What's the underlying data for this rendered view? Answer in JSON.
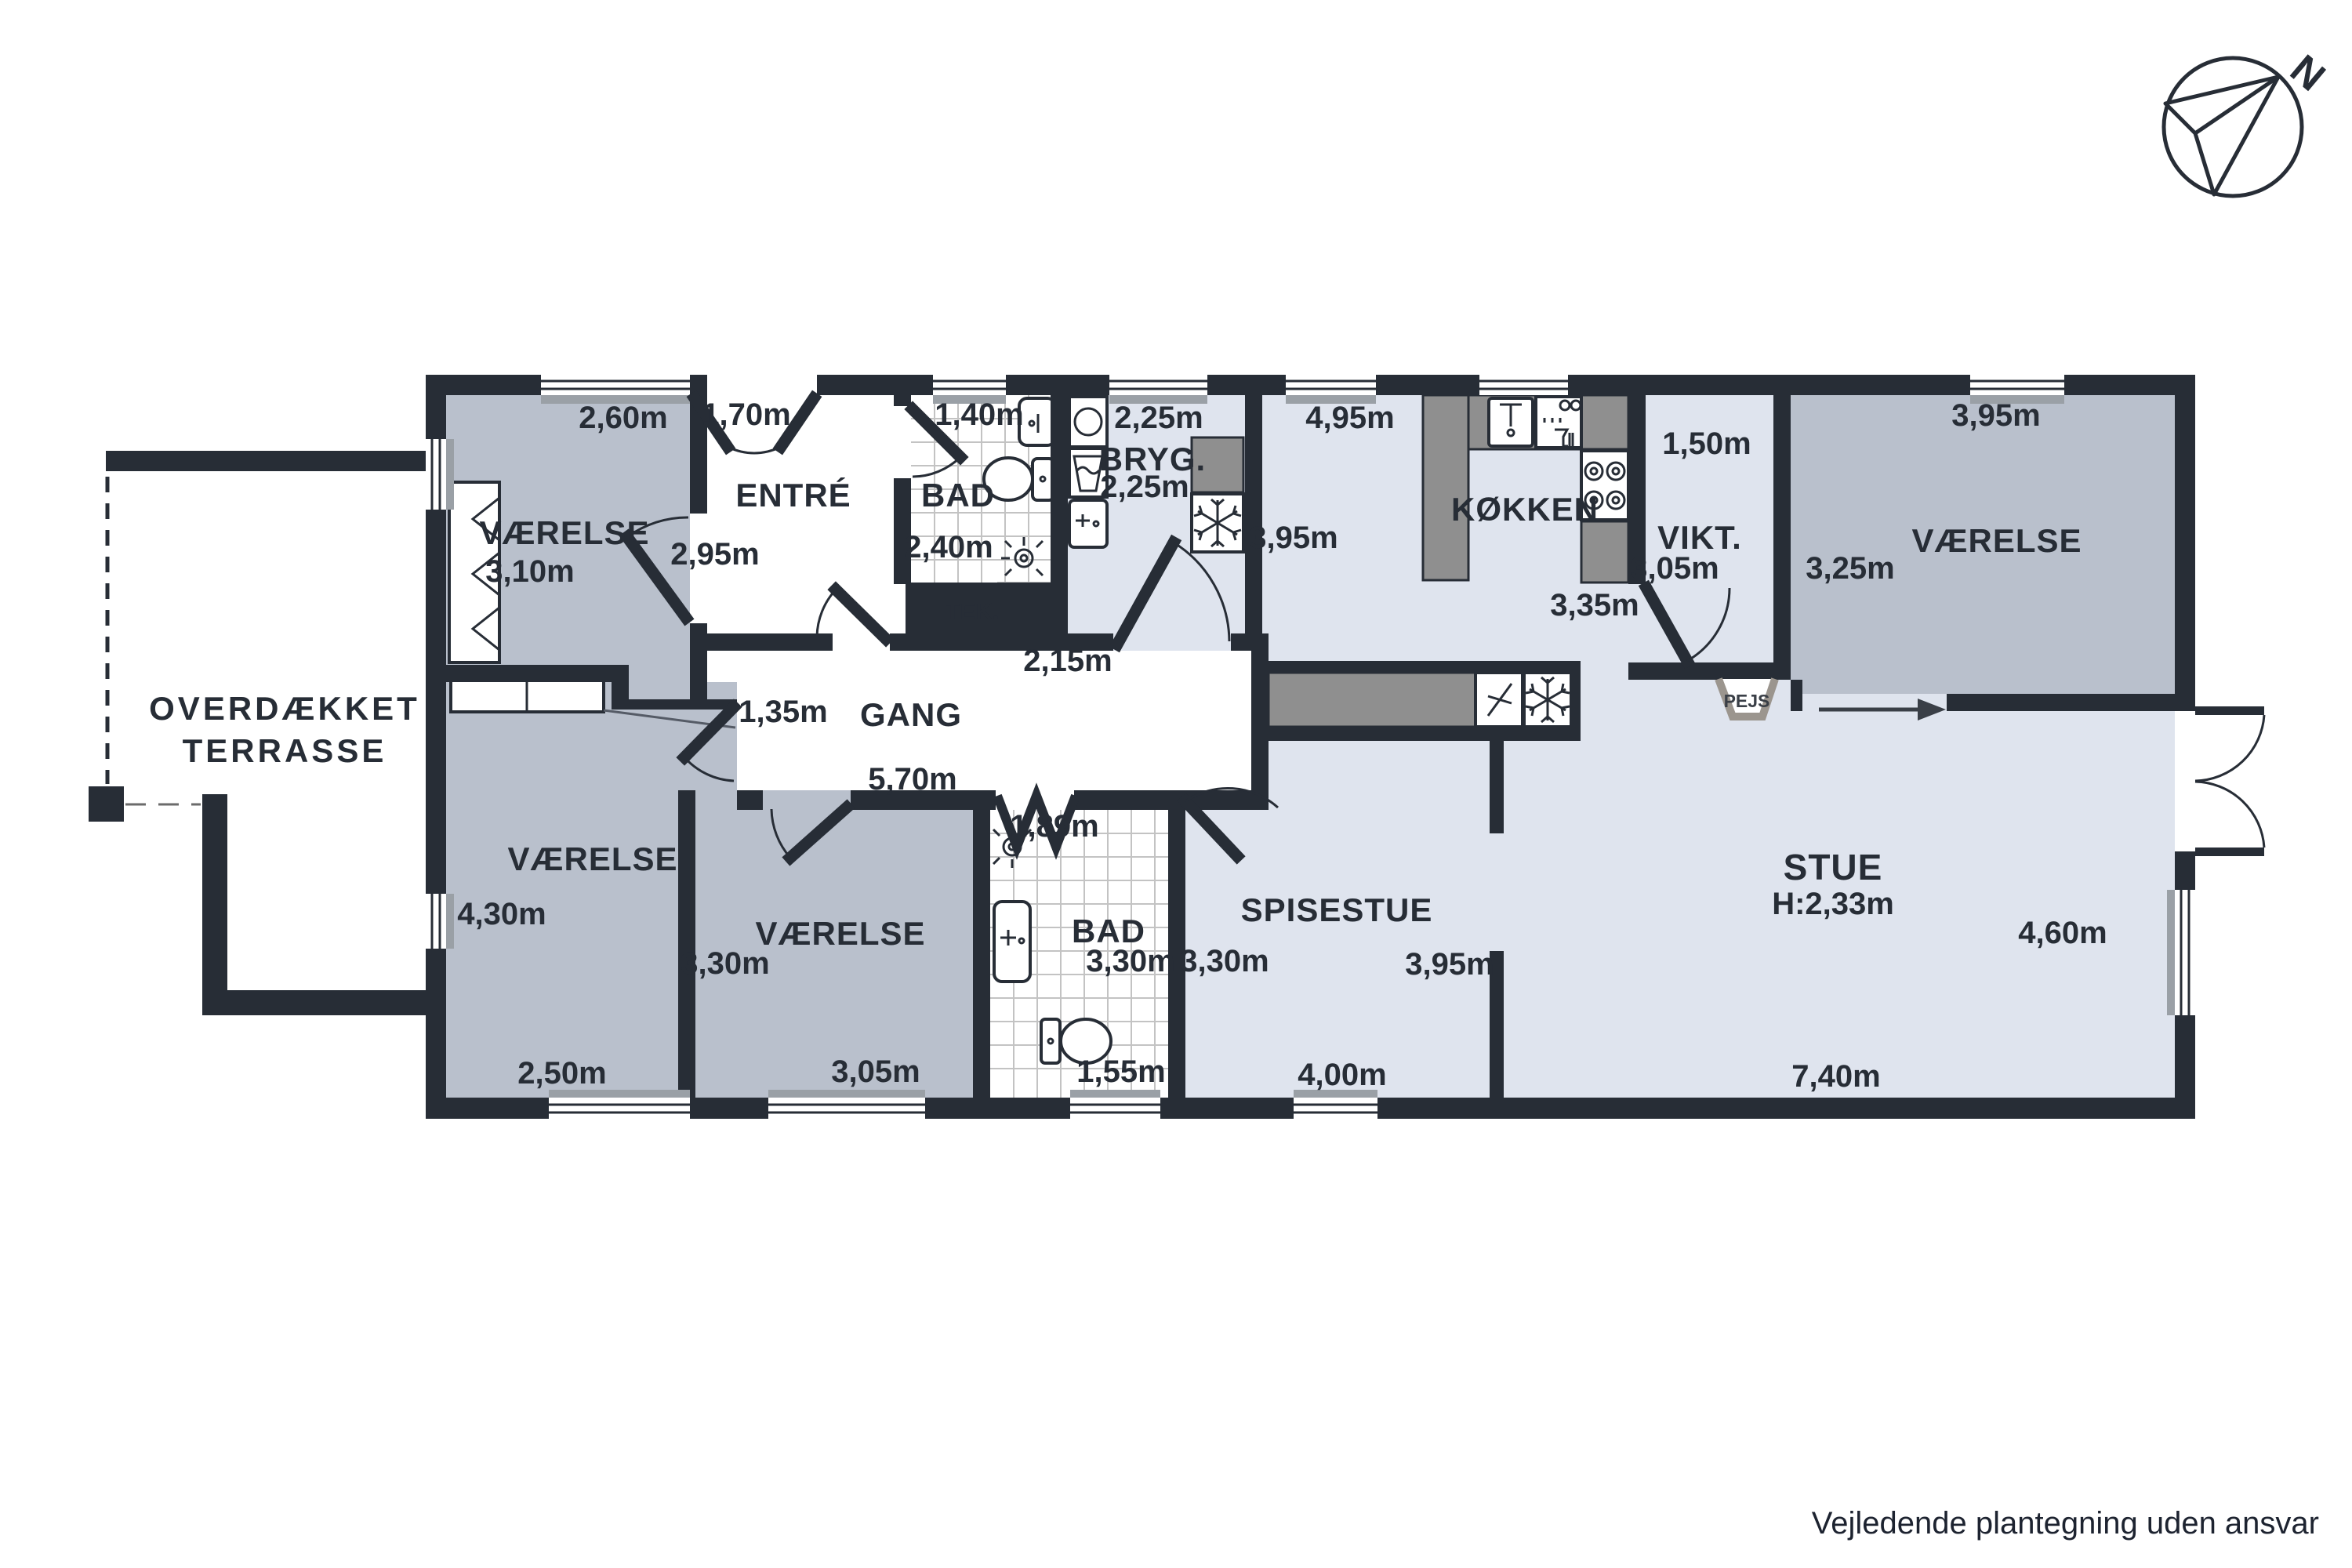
{
  "plan": {
    "disclaimer": "Vejledende plantegning uden ansvar",
    "compass_label": "N",
    "terrace": {
      "line1": "OVERDÆKKET",
      "line2": "TERRASSE"
    },
    "pejs_label": "PEJS",
    "rooms": {
      "vaerelse_nw": {
        "name": "VÆRELSE",
        "w": "2,60m",
        "h": "3,10m"
      },
      "entre": {
        "name": "ENTRÉ",
        "w": "1,70m",
        "h": "2,95m"
      },
      "bad_top": {
        "name": "BAD",
        "w": "1,40m",
        "h": "2,40m"
      },
      "tek": {
        "name": "TEK."
      },
      "bryg": {
        "name": "BRYG.",
        "w": "2,25m",
        "h": "2,25m"
      },
      "dining": {
        "w": "4,95m",
        "h": "3,95m"
      },
      "koekken": {
        "name": "KØKKEN",
        "w": "3,35m"
      },
      "vikt": {
        "name": "VIKT.",
        "w": "1,50m",
        "h": "3,05m"
      },
      "vaerelse_ne": {
        "name": "VÆRELSE",
        "w": "3,95m",
        "h": "3,25m"
      },
      "gang": {
        "name": "GANG",
        "left": "1,35m",
        "bottom": "5,70m",
        "right": "2,15m"
      },
      "vaerelse_sw": {
        "name": "VÆRELSE",
        "h": "4,30m",
        "w": "2,50m"
      },
      "vaerelse_s": {
        "name": "VÆRELSE",
        "h": "3,30m",
        "w": "3,05m"
      },
      "bad_bottom": {
        "name": "BAD",
        "top": "1,89m",
        "h": "3,30m",
        "w": "1,55m"
      },
      "spisestue": {
        "name": "SPISESTUE",
        "left": "3,30m",
        "right": "3,95m",
        "bottom": "4,00m"
      },
      "stue": {
        "name": "STUE",
        "ceiling": "H:2,33m",
        "right": "4,60m",
        "bottom": "7,40m"
      }
    },
    "colors": {
      "wall": "#272d36",
      "room_gray": "#b9c0cc",
      "room_blue": "#dfe4ee",
      "counter_gray": "#8f8f8f",
      "text": "#272d36"
    }
  }
}
